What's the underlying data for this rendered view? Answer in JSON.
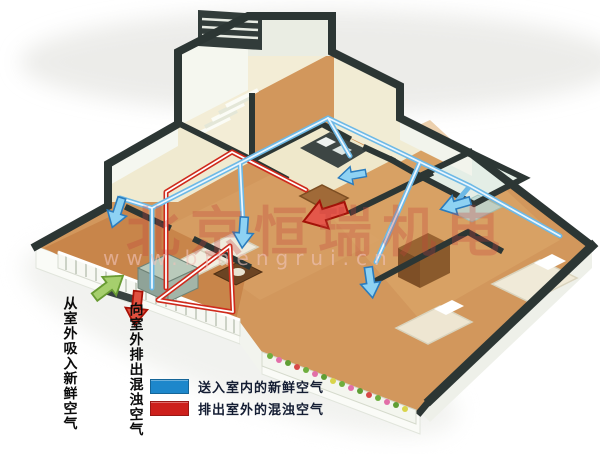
{
  "annotations": {
    "intake_label": "从室外吸入新鲜空气",
    "exhaust_label": "向室外排出混浊空气"
  },
  "legend": {
    "items": [
      {
        "name": "fresh-air-supply",
        "color": "#1d87cb",
        "swatch_css": "background:#1d87cb",
        "label": "送入室内的新鲜空气"
      },
      {
        "name": "polluted-air-exhaust",
        "color": "#cd201c",
        "swatch_css": "background:#cd201c",
        "label": "排出室外的混浊空气"
      }
    ]
  },
  "watermark": {
    "brand": "北京恒瑞机电",
    "url": "www.bjhengrui.cn"
  },
  "colors": {
    "duct_fresh": "#6db9e6",
    "duct_exhaust": "#cf2a1c",
    "arrow_fresh": "#8ed2f3",
    "arrow_exhaust_big": "#e4574a",
    "arrow_intake_green": "#a6cf6d",
    "wall_top": "#2c3634",
    "floor_wood": "#d2975c",
    "floor_wood_dark": "#c8854a",
    "floor_cream": "#f0ead0",
    "floor_tile": "#e4eee6"
  }
}
